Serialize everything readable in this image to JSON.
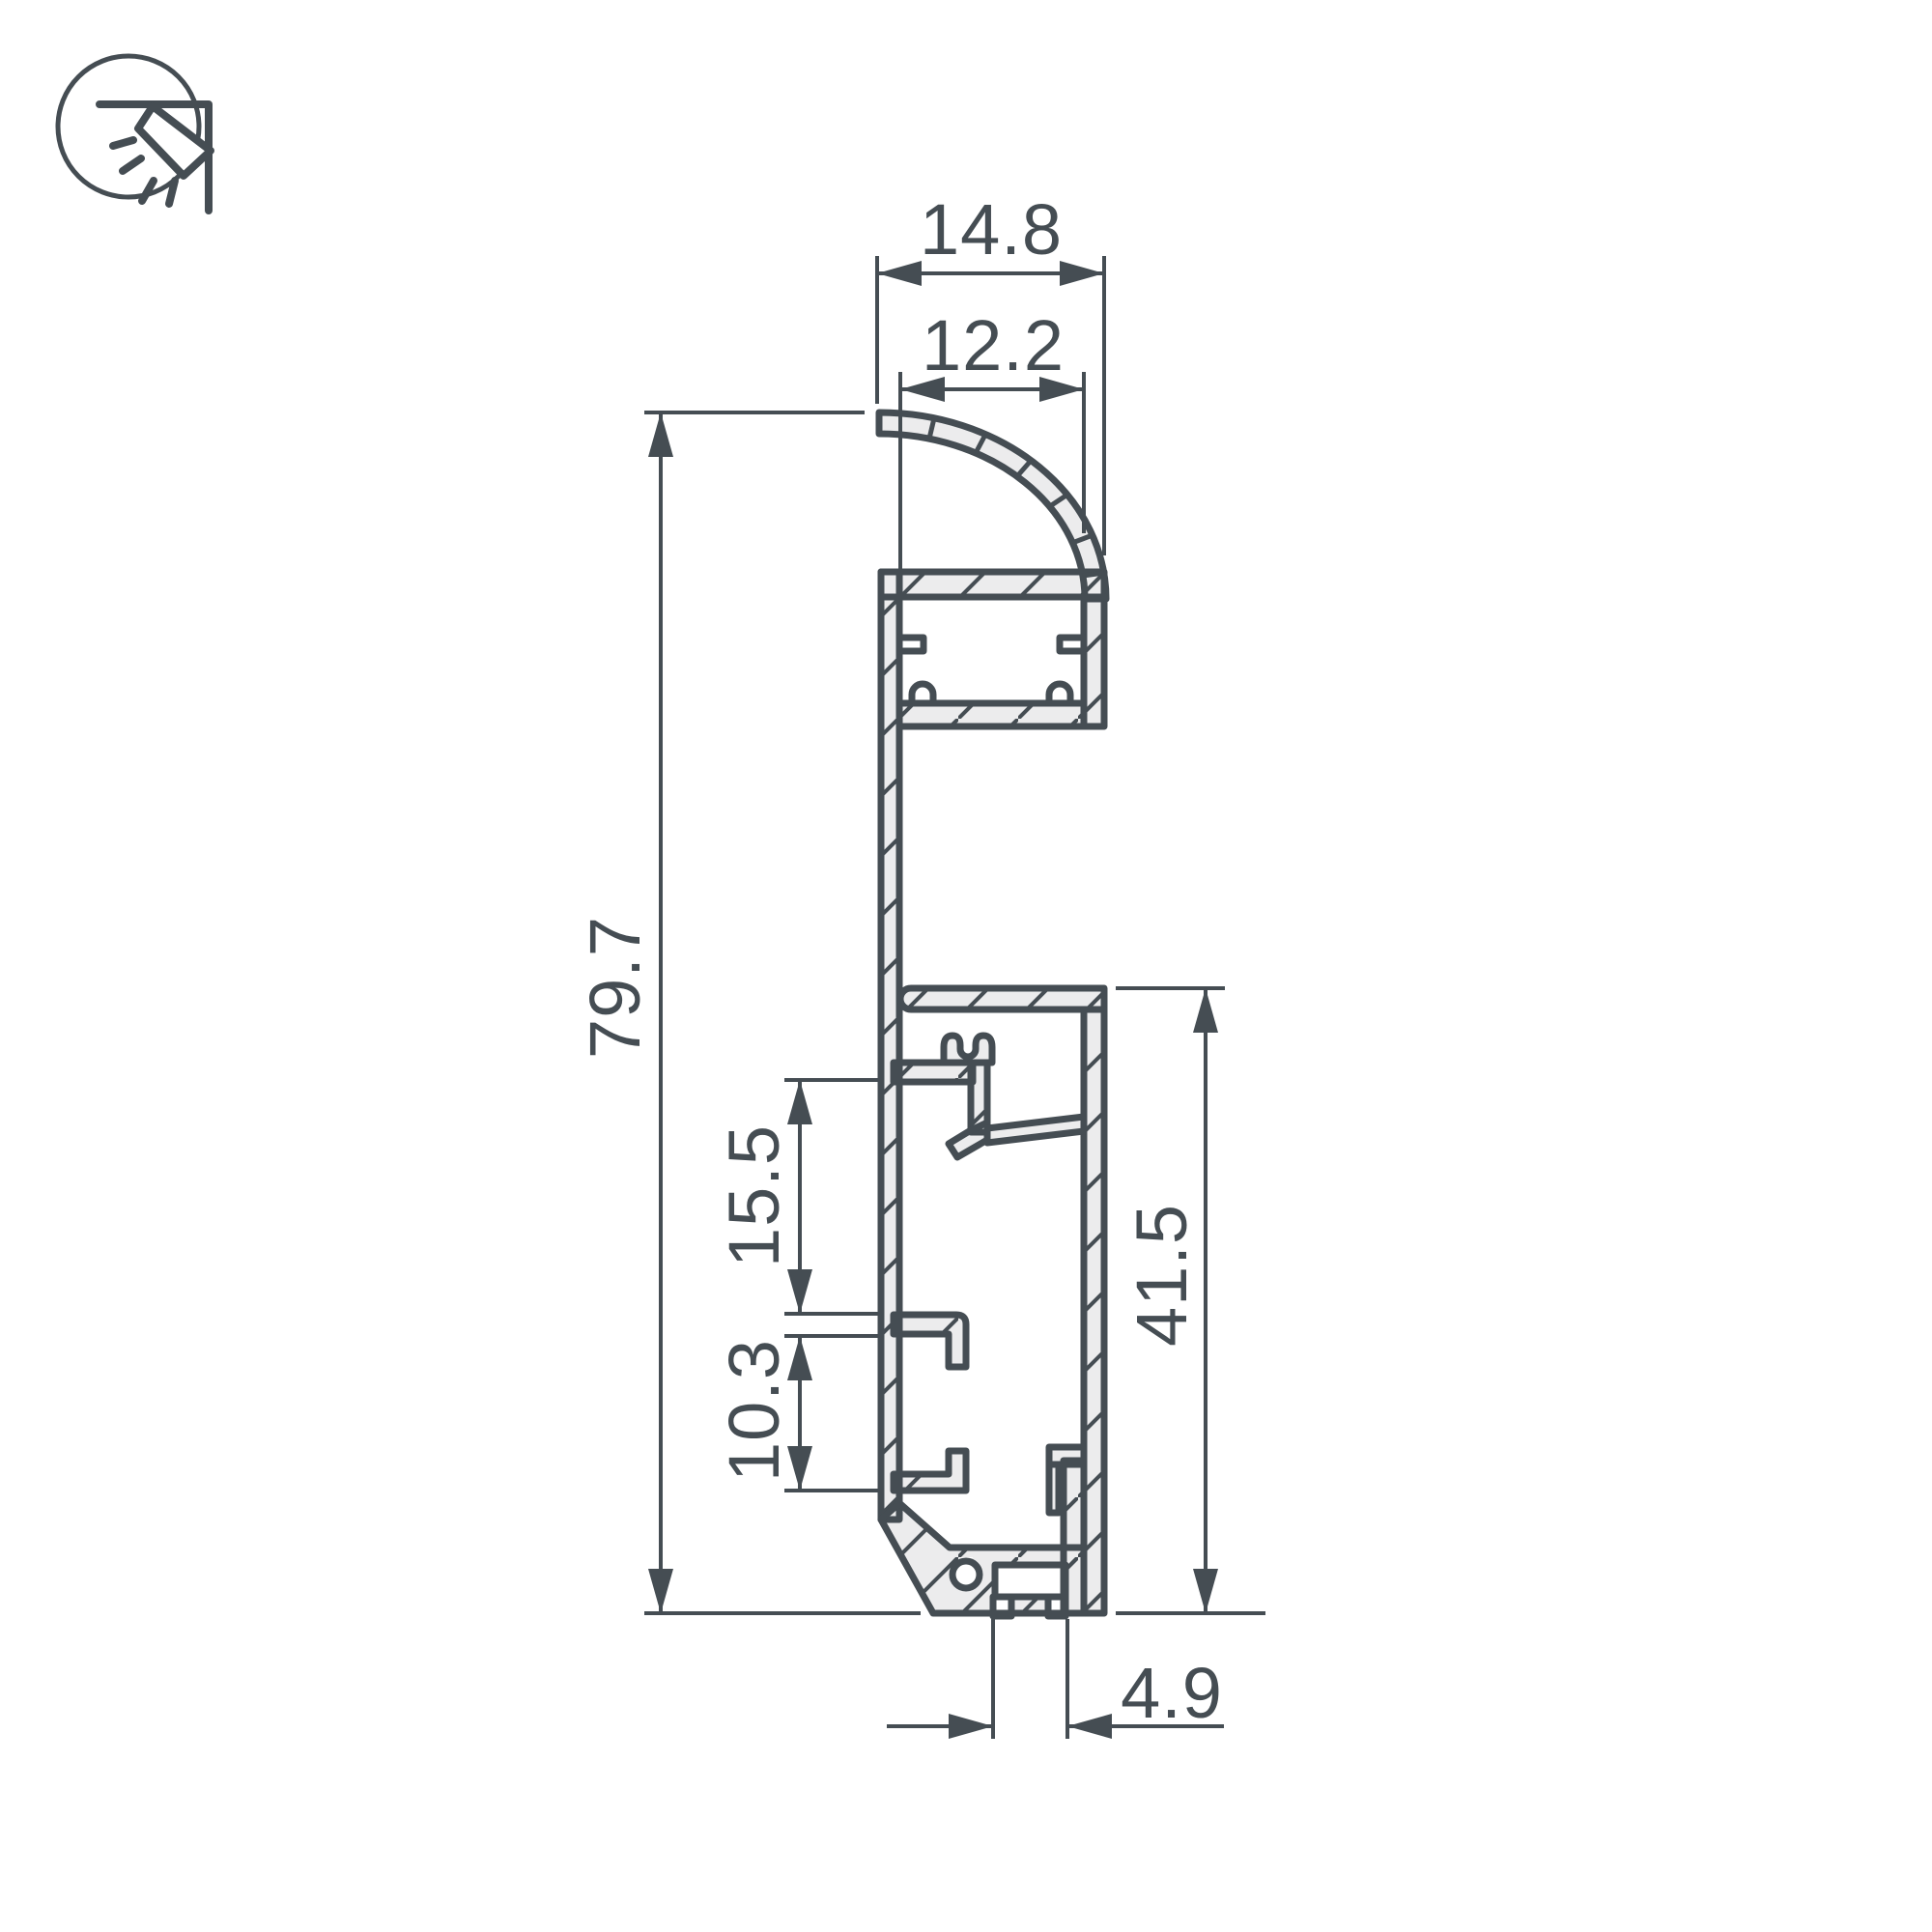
{
  "drawing": {
    "type": "technical-cross-section",
    "subject": "aluminum LED profile section with dimensions",
    "background": "#ffffff",
    "line_color": "#454d53",
    "material_fill": "#ececed",
    "icon": {
      "name": "wall-corner-light-icon"
    },
    "dimensions": {
      "top_width": "14.8",
      "diffuser_width": "12.2",
      "overall_height": "79.7",
      "upper_slot_height": "15.5",
      "lower_slot_height": "10.3",
      "base_height": "41.5",
      "foot_width": "4.9"
    }
  }
}
